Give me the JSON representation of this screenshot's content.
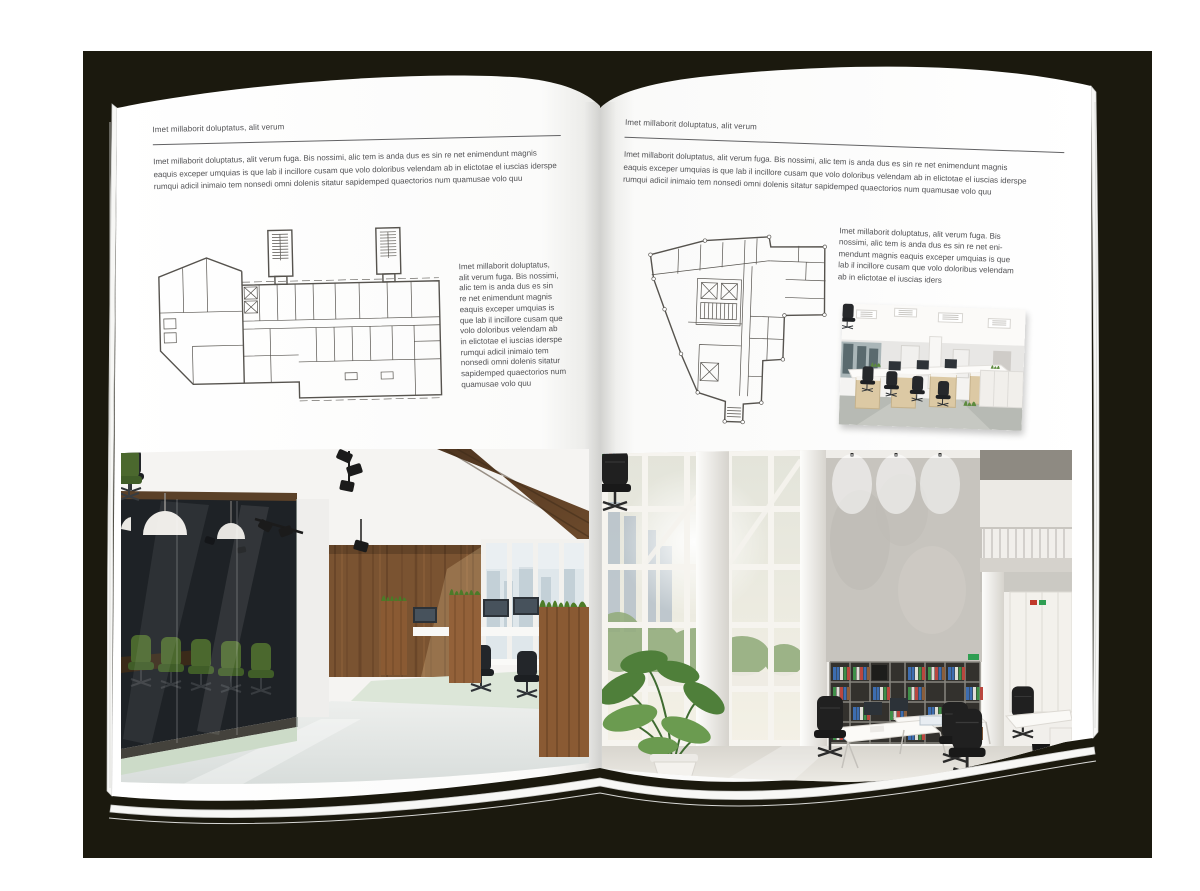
{
  "canvas": {
    "backdrop_color": "#1b190e",
    "page_color": "#ffffff",
    "text_color": "#515154"
  },
  "left_page": {
    "header": "Imet millaborit doluptatus, alit verum",
    "intro": "Imet millaborit doluptatus, alit verum fuga. Bis nossimi, alic tem is anda dus es sin re net enimendunt magnis\neaquis exceper umquias is que lab il incillore cusam que volo doloribus velendam ab in elictotae el iuscias iderspe\nrumqui adicil inimaio tem nonsedi omni dolenis sitatur sapidemped quaectorios num quamusae volo quu",
    "side_text": "Imet millaborit doluptatus,\nalit verum fuga. Bis nossimi,\nalic tem is anda dus es sin\nre net enimendunt magnis\neaquis exceper umquias is\nque lab il incillore cusam que\nvolo doloribus velendam ab\nin elictotae el iuscias iderspe\nrumqui adicil inimaio tem\nnonsedi omni dolenis sitatur\nsapidemped quaectorios num\nquamusae volo quu",
    "floor_plan_label": "wide-building-floor-plan",
    "photo_label": "dark-wood-and-glass-office-interior"
  },
  "right_page": {
    "header": "Imet millaborit doluptatus, alit verum",
    "intro": "Imet millaborit doluptatus, alit verum fuga. Bis nossimi, alic tem is anda dus es sin re net enimendunt magnis\neaquis exceper umquias is que lab il incillore cusam que volo doloribus velendam ab in elictotae el iuscias iderspe\nrumqui adicil inimaio tem nonsedi omni dolenis sitatur sapidemped quaectorios num quamusae volo quu",
    "side_text": "Imet millaborit doluptatus, alit verum fuga. Bis\nnossimi, alic tem is anda dus es sin re net eni-\nmendunt magnis eaquis exceper umquias is que\nlab il incillore cusam que volo doloribus velendam\nab in elictotae el iuscias iders",
    "floor_plan_label": "tall-irregular-building-floor-plan",
    "photo_small_label": "white-open-office-with-desks",
    "photo_large_label": "bright-atrium-office-with-bookshelves"
  }
}
